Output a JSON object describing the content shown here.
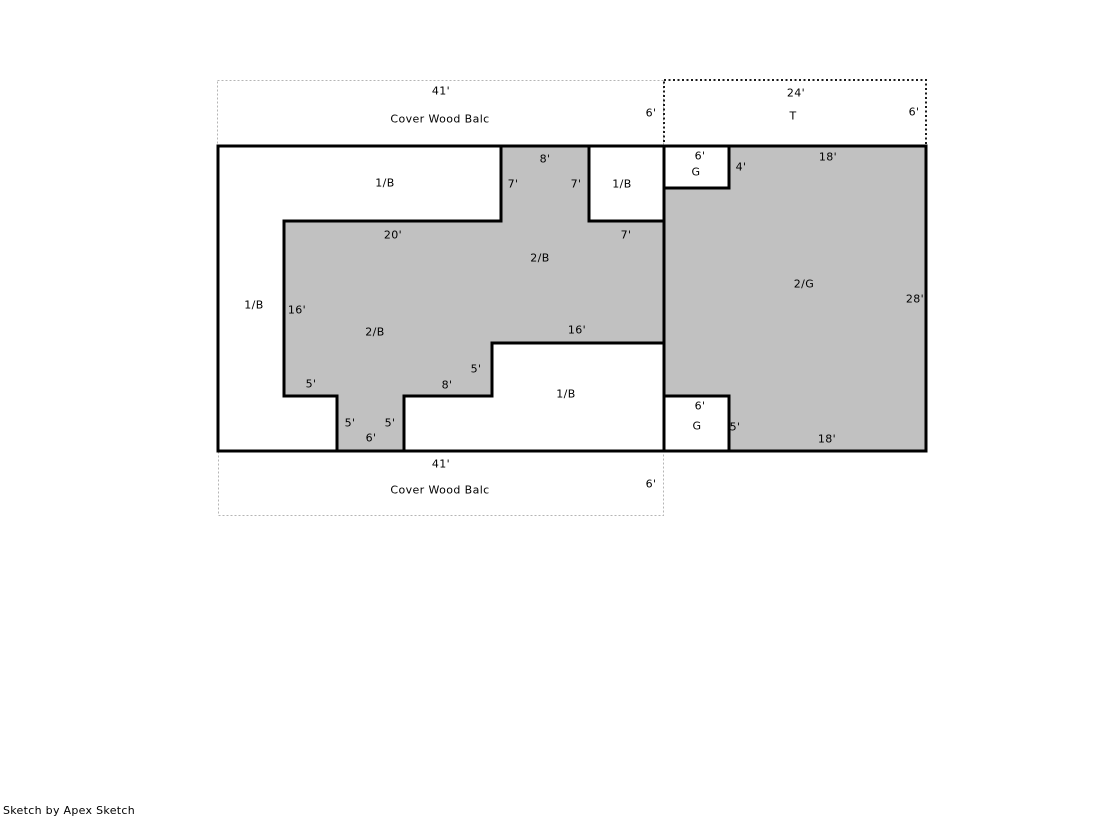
{
  "colors": {
    "area_fill": "#c1c1c1",
    "outline": "#000000",
    "balcony_dotted": "#b5b5b5",
    "terrace_dotted": "#1c1c1c",
    "background": "#ffffff"
  },
  "footer": {
    "credit": "Sketch by Apex Sketch"
  },
  "sketch": {
    "areas_legend": [
      {
        "code": "1/B",
        "meaning_shown": "1/B"
      },
      {
        "code": "2/B",
        "meaning_shown": "2/B"
      },
      {
        "code": "2/G",
        "meaning_shown": "2/G"
      },
      {
        "code": "G",
        "meaning_shown": "G"
      },
      {
        "code": "T",
        "meaning_shown": "T"
      },
      {
        "code": "Cover Wood Balc",
        "meaning_shown": "Cover Wood Balc"
      }
    ],
    "labels": [
      {
        "id": "top-balcony-41",
        "kind": "dim",
        "text": "41'",
        "x": 441,
        "y": 91
      },
      {
        "id": "top-balcony-name",
        "kind": "area",
        "text": "Cover Wood Balc",
        "x": 440,
        "y": 119
      },
      {
        "id": "top-balcony-6",
        "kind": "dim",
        "text": "6'",
        "x": 651,
        "y": 113
      },
      {
        "id": "terrace-24",
        "kind": "dim",
        "text": "24'",
        "x": 796,
        "y": 93
      },
      {
        "id": "terrace-name",
        "kind": "area",
        "text": "T",
        "x": 793,
        "y": 116
      },
      {
        "id": "terrace-6",
        "kind": "dim",
        "text": "6'",
        "x": 914,
        "y": 112
      },
      {
        "id": "upper-column-8",
        "kind": "dim",
        "text": "8'",
        "x": 545,
        "y": 159
      },
      {
        "id": "first-balc-main",
        "kind": "area",
        "text": "1/B",
        "x": 385,
        "y": 183
      },
      {
        "id": "upper-column-7-left",
        "kind": "dim",
        "text": "7'",
        "x": 513,
        "y": 184
      },
      {
        "id": "upper-column-7-right",
        "kind": "dim",
        "text": "7'",
        "x": 576,
        "y": 184
      },
      {
        "id": "first-balc-topright",
        "kind": "area",
        "text": "1/B",
        "x": 622,
        "y": 184
      },
      {
        "id": "garage-top-6",
        "kind": "dim",
        "text": "6'",
        "x": 700,
        "y": 156
      },
      {
        "id": "garage-top-name",
        "kind": "area",
        "text": "G",
        "x": 696,
        "y": 172
      },
      {
        "id": "garage-top-4",
        "kind": "dim",
        "text": "4'",
        "x": 741,
        "y": 167
      },
      {
        "id": "upper-18",
        "kind": "dim",
        "text": "18'",
        "x": 828,
        "y": 157
      },
      {
        "id": "mid-20",
        "kind": "dim",
        "text": "20'",
        "x": 393,
        "y": 235
      },
      {
        "id": "mid-7",
        "kind": "dim",
        "text": "7'",
        "x": 626,
        "y": 235
      },
      {
        "id": "second-balc-upper",
        "kind": "area",
        "text": "2/B",
        "x": 540,
        "y": 258
      },
      {
        "id": "second-garage-name",
        "kind": "area",
        "text": "2/G",
        "x": 804,
        "y": 284
      },
      {
        "id": "right-28",
        "kind": "dim",
        "text": "28'",
        "x": 915,
        "y": 299
      },
      {
        "id": "first-balc-left",
        "kind": "area",
        "text": "1/B",
        "x": 254,
        "y": 305
      },
      {
        "id": "left-16",
        "kind": "dim",
        "text": "16'",
        "x": 297,
        "y": 310
      },
      {
        "id": "second-balc-lower",
        "kind": "area",
        "text": "2/B",
        "x": 375,
        "y": 332
      },
      {
        "id": "mid-16",
        "kind": "dim",
        "text": "16'",
        "x": 577,
        "y": 330
      },
      {
        "id": "step-5-upper",
        "kind": "dim",
        "text": "5'",
        "x": 476,
        "y": 369
      },
      {
        "id": "step-5-left",
        "kind": "dim",
        "text": "5'",
        "x": 311,
        "y": 384
      },
      {
        "id": "step-8",
        "kind": "dim",
        "text": "8'",
        "x": 447,
        "y": 385
      },
      {
        "id": "first-balc-bottom",
        "kind": "area",
        "text": "1/B",
        "x": 566,
        "y": 394
      },
      {
        "id": "strip-5-left",
        "kind": "dim",
        "text": "5'",
        "x": 350,
        "y": 423
      },
      {
        "id": "strip-5-right",
        "kind": "dim",
        "text": "5'",
        "x": 390,
        "y": 423
      },
      {
        "id": "strip-6",
        "kind": "dim",
        "text": "6'",
        "x": 371,
        "y": 438
      },
      {
        "id": "garage-bottom-6",
        "kind": "dim",
        "text": "6'",
        "x": 700,
        "y": 406
      },
      {
        "id": "garage-bottom-name",
        "kind": "area",
        "text": "G",
        "x": 697,
        "y": 426
      },
      {
        "id": "garage-bottom-5",
        "kind": "dim",
        "text": "5'",
        "x": 735,
        "y": 427
      },
      {
        "id": "lower-18",
        "kind": "dim",
        "text": "18'",
        "x": 827,
        "y": 439
      },
      {
        "id": "bottom-balcony-41",
        "kind": "dim",
        "text": "41'",
        "x": 441,
        "y": 464
      },
      {
        "id": "bottom-balcony-name",
        "kind": "area",
        "text": "Cover Wood Balc",
        "x": 440,
        "y": 490
      },
      {
        "id": "bottom-balcony-6",
        "kind": "dim",
        "text": "6'",
        "x": 651,
        "y": 484
      }
    ]
  }
}
